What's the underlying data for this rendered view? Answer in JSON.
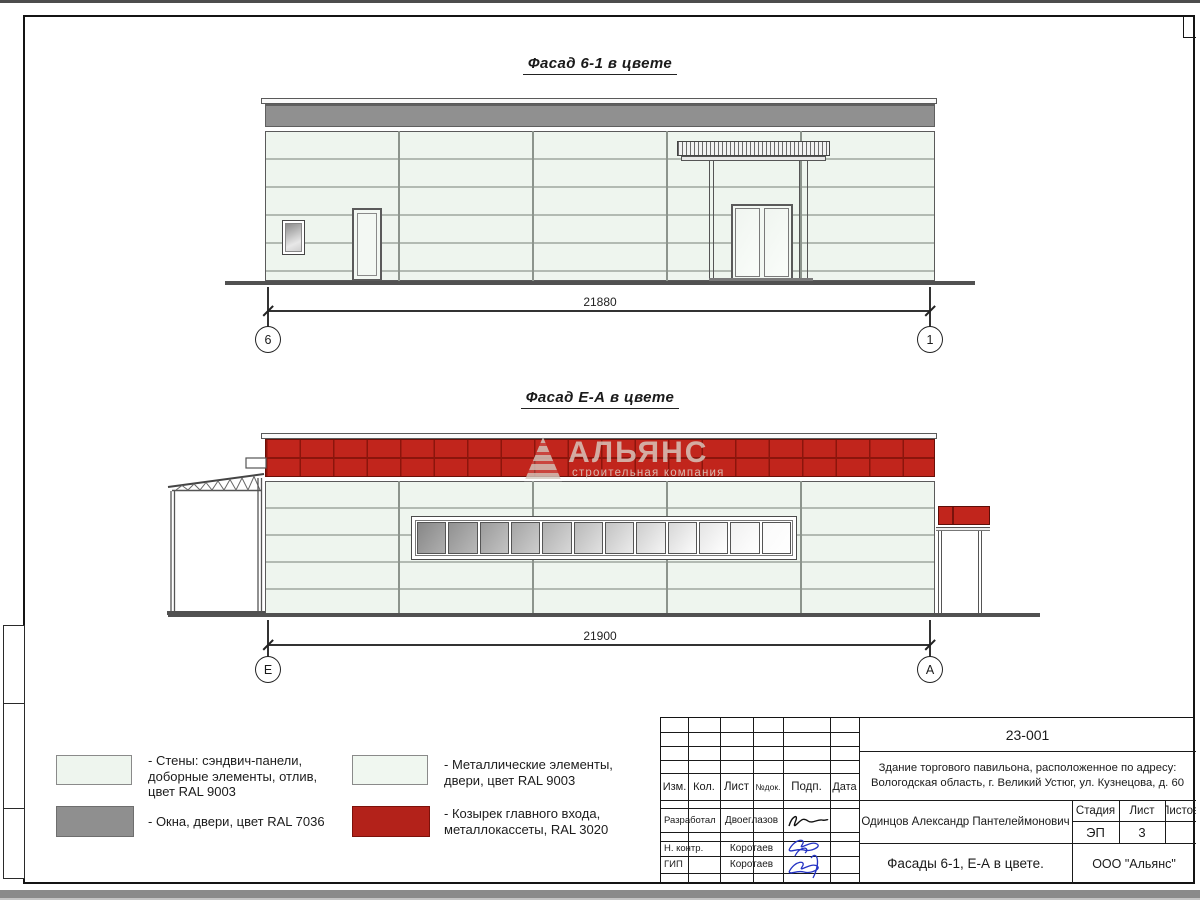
{
  "facade1": {
    "title": "Фасад 6-1 в цвете",
    "dimension": "21880",
    "axis_left": "6",
    "axis_right": "1"
  },
  "facade2": {
    "title": "Фасад Е-А в цвете",
    "dimension": "21900",
    "axis_left": "Е",
    "axis_right": "А"
  },
  "watermark": {
    "name": "АЛЬЯНС",
    "tagline": "строительная компания"
  },
  "legend": {
    "wall": "- Стены: сэндвич-панели,\nдоборные элементы, отлив,\nцвет RAL 9003",
    "windows": "- Окна, двери, цвет RAL 7036",
    "metal": "- Металлические элементы,\nдвери, цвет RAL 9003",
    "canopy": "- Козырек главного входа,\nметаллокассеты, RAL 3020"
  },
  "colors": {
    "wall_panel": "#eef5ee",
    "window_grey": "#8f8f8f",
    "metal_white": "#f0f7f0",
    "canopy_red": "#c1251c"
  },
  "title_block": {
    "doc_number": "23-001",
    "project_line1": "Здание торгового павильона, расположенное по адресу:",
    "project_line2": "Вологодская область, г. Великий Устюг, ул. Кузнецова, д. 60",
    "col_izm": "Изм.",
    "col_kol": "Кол.",
    "col_list": "Лист",
    "col_ndok": "№док.",
    "col_podp": "Подп.",
    "col_data": "Дата",
    "row_developed_label": "Разработал",
    "row_developed_name": "Двоеглазов",
    "row_ncontr_label": "Н. контр.",
    "row_ncontr_name": "Коротаев",
    "row_gip_label": "ГИП",
    "row_gip_name": "Коротаев",
    "chief_architect": "Одинцов Александр Пантелеймонович",
    "stage_label": "Стадия",
    "sheet_label": "Лист",
    "sheets_label": "Листов",
    "stage_value": "ЭП",
    "sheet_value": "3",
    "drawing_title": "Фасады 6-1, Е-А в цвете.",
    "company": "ООО \"Альянс\""
  }
}
